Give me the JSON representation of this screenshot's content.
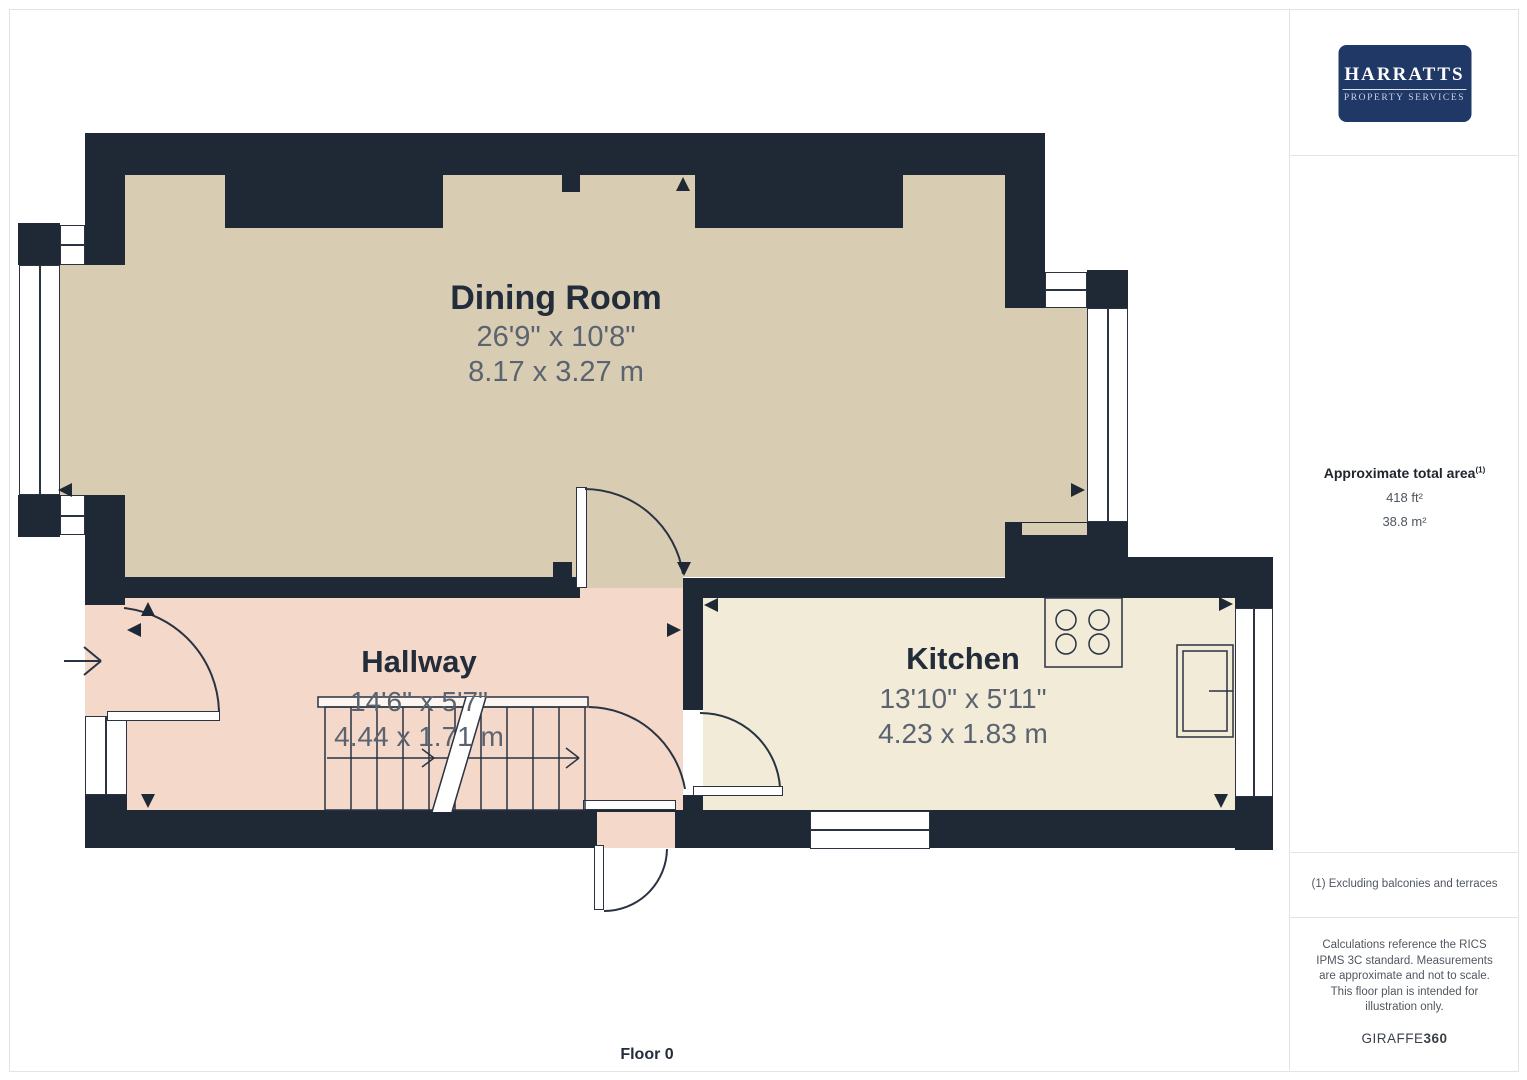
{
  "palette": {
    "wall": "#1f2835",
    "line": "#2a3342",
    "dining": "#d8cdb2",
    "hallway": "#f4d8c9",
    "kitchen": "#f1ebd8",
    "title_text": "#232c3a",
    "dim_text": "#5b6370",
    "logo_bg": "#1f3866",
    "sidebar_border": "#e3e3e3",
    "sidebar_text": "#51575f",
    "brand_text": "#3b4148"
  },
  "logo": {
    "line1": "HARRATTS",
    "line2": "PROPERTY SERVICES"
  },
  "floor_label": "Floor 0",
  "rooms": [
    {
      "name": "Dining Room",
      "imperial": "26'9\" x 10'8\"",
      "metric": "8.17 x 3.27 m"
    },
    {
      "name": "Hallway",
      "imperial": "14'6\" x 5'7\"",
      "metric": "4.44 x 1.71 m"
    },
    {
      "name": "Kitchen",
      "imperial": "13'10\" x 5'11\"",
      "metric": "4.23 x 1.83 m"
    }
  ],
  "sidebar": {
    "area_heading": "Approximate total area",
    "area_heading_sup": "(1)",
    "area_ft": "418 ft²",
    "area_m": "38.8 m²",
    "footnote": "(1) Excluding balconies and terraces",
    "disclaimer": "Calculations reference the RICS IPMS 3C standard. Measurements are approximate and not to scale. This floor plan is intended for illustration only.",
    "brand": "GIRAFFE",
    "brand_suffix": "360"
  }
}
